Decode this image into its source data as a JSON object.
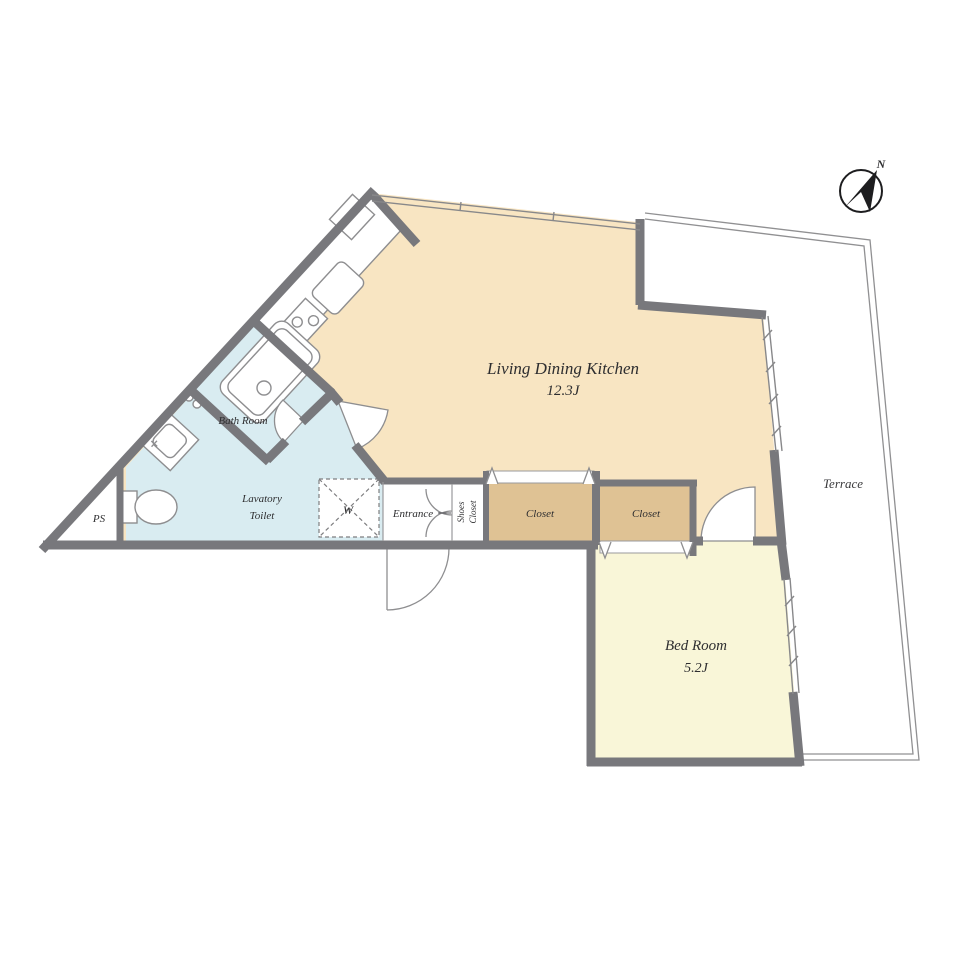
{
  "plan": {
    "rooms": {
      "ldk": {
        "label": "Living Dining Kitchen",
        "size": "12.3J"
      },
      "bedroom": {
        "label": "Bed Room",
        "size": "5.2J"
      },
      "terrace": {
        "label": "Terrace"
      },
      "bathroom": {
        "label": "Bath Room"
      },
      "lavatory": {
        "line1": "Lavatory",
        "line2": "Toilet"
      },
      "entrance": {
        "label": "Entrance"
      },
      "shoes_closet": {
        "line1": "Shoes",
        "line2": "Closet"
      },
      "closet_1": {
        "label": "Closet"
      },
      "closet_2": {
        "label": "Closet"
      },
      "ps": {
        "label": "PS"
      },
      "washer": {
        "label": "W"
      }
    },
    "compass": {
      "label": "N"
    },
    "colors": {
      "ldk_fill": "#f8e5c2",
      "bedroom_fill": "#f9f6d8",
      "closet_fill": "#dfc294",
      "lavatory_fill": "#d9ecf1",
      "wall": "#78787c",
      "fixture_line": "#8e8e90",
      "railing_line": "#909092",
      "white": "#ffffff"
    }
  }
}
